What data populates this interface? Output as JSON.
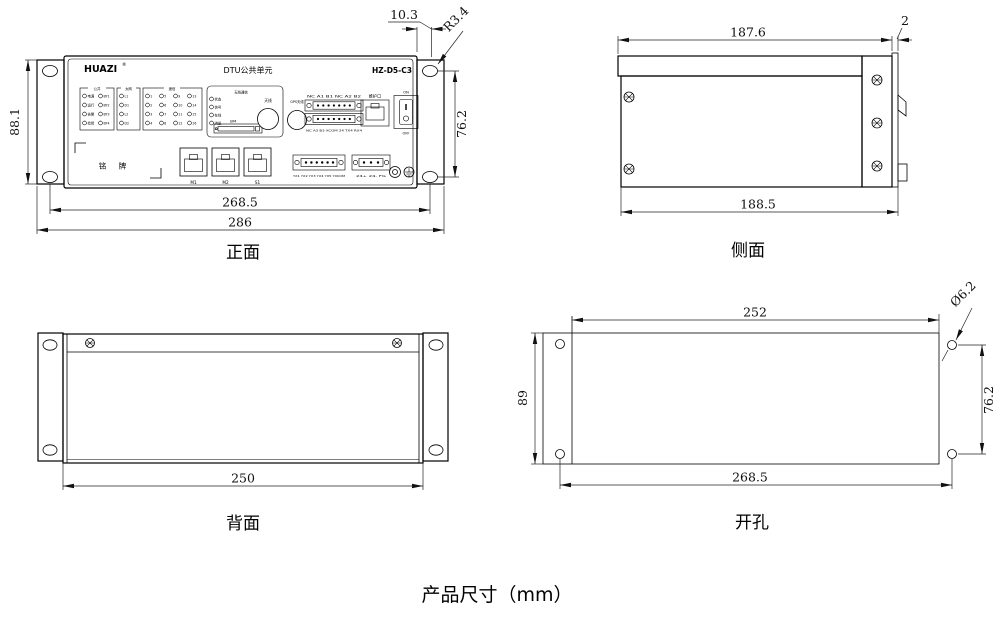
{
  "title": "产品尺寸（mm）",
  "front": {
    "label": "正面",
    "brand": "HUAZI",
    "reg": "®",
    "header": "DTU公共单元",
    "model": "HZ-D5-C3",
    "nameplate": "铭 牌",
    "groups": {
      "common": {
        "header": "公共",
        "col1": [
          "电源",
          "运行",
          "告警",
          "检修"
        ],
        "col2": [
          "BY1",
          "BY2",
          "BY3",
          "BY4"
        ]
      },
      "eth": {
        "header": "太网",
        "items": [
          "L1",
          "D1",
          "L2",
          "D2"
        ]
      },
      "yx": {
        "header": "遥信",
        "cols": [
          [
            "1",
            "2",
            "3",
            "4"
          ],
          [
            "5",
            "6",
            "7",
            "8"
          ],
          [
            "9",
            "10",
            "11",
            "12"
          ],
          [
            "13",
            "14",
            "15",
            "16"
          ]
        ]
      },
      "wireless": {
        "header": "无线通信",
        "items": [
          "状态",
          "信号",
          "在线",
          "流量"
        ],
        "sim": "SIM",
        "antenna": "天线",
        "gps": "GPS天线"
      }
    },
    "io": {
      "row_top": "NC A1 B1 NC A2 B2",
      "row_bottom": "NC A3 B3 XCOM 24 TX4 RX4",
      "maintenance": "维护口",
      "on": "ON",
      "off": "OFF",
      "ports": [
        "M1",
        "M2",
        "S1"
      ],
      "yx_labels": "YX1 YX2 YX3 YX4 YX5 YXCOM",
      "pwr_labels": "24+ 24- FG"
    },
    "dims": {
      "w": "286",
      "wh": "268.5",
      "h": "88.1",
      "ear": "10.3",
      "r": "R3.4",
      "hh": "76.2"
    }
  },
  "side": {
    "label": "侧面",
    "dims": {
      "top": "187.6",
      "plate": "2",
      "bottom": "188.5"
    }
  },
  "back": {
    "label": "背面",
    "dims": {
      "w": "250"
    }
  },
  "cutout": {
    "label": "开孔",
    "dims": {
      "top": "252",
      "dia": "Ø6.2",
      "h": "89",
      "vh": "76.2",
      "wh": "268.5"
    }
  }
}
